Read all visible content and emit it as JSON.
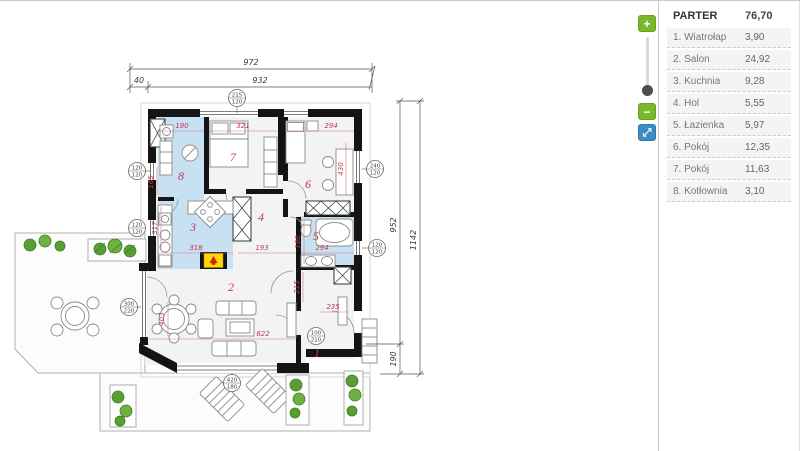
{
  "sidebar": {
    "header": {
      "label": "PARTER",
      "value": "76,70"
    },
    "rooms": [
      {
        "label": "1. Wiatrołap",
        "value": "3,90"
      },
      {
        "label": "2. Salon",
        "value": "24,92"
      },
      {
        "label": "3. Kuchnia",
        "value": "9,28"
      },
      {
        "label": "4. Hol",
        "value": "5,55"
      },
      {
        "label": "5. Łazienka",
        "value": "5,97"
      },
      {
        "label": "6. Pokój",
        "value": "12,35"
      },
      {
        "label": "7. Pokój",
        "value": "11,63"
      },
      {
        "label": "8. Kotłownia",
        "value": "3,10"
      }
    ]
  },
  "controls": {
    "zoom_in": "+",
    "zoom_out": "−",
    "fullscreen": "⤢"
  },
  "plan": {
    "rooms": [
      "1",
      "2",
      "3",
      "4",
      "5",
      "6",
      "7",
      "8"
    ],
    "outer_dims": {
      "total_width": "972",
      "left_offset": "40",
      "main_width": "932",
      "main_height": "952",
      "total_height": "1142",
      "terrace_height": "190"
    },
    "inner_dims": [
      "190",
      "321",
      "294",
      "430",
      "165",
      "317",
      "318",
      "193",
      "294",
      "180",
      "215",
      "235",
      "622",
      "403"
    ],
    "windows": [
      {
        "w": "215",
        "h": "120"
      },
      {
        "w": "120",
        "h": "120"
      },
      {
        "w": "120",
        "h": "120"
      },
      {
        "w": "240",
        "h": "120"
      },
      {
        "w": "120",
        "h": "120"
      },
      {
        "w": "300",
        "h": "220"
      },
      {
        "w": "100",
        "h": "210"
      },
      {
        "w": "420",
        "h": "180"
      }
    ],
    "colors": {
      "wall": "#141414",
      "wet_room_fill": "#c8e1f2",
      "room_fill": "#f3f3f4",
      "label_red": "#c2394b",
      "fireplace_yellow": "#ffd800",
      "accent_green": "#79b72b",
      "accent_blue": "#3c8dc5"
    }
  }
}
